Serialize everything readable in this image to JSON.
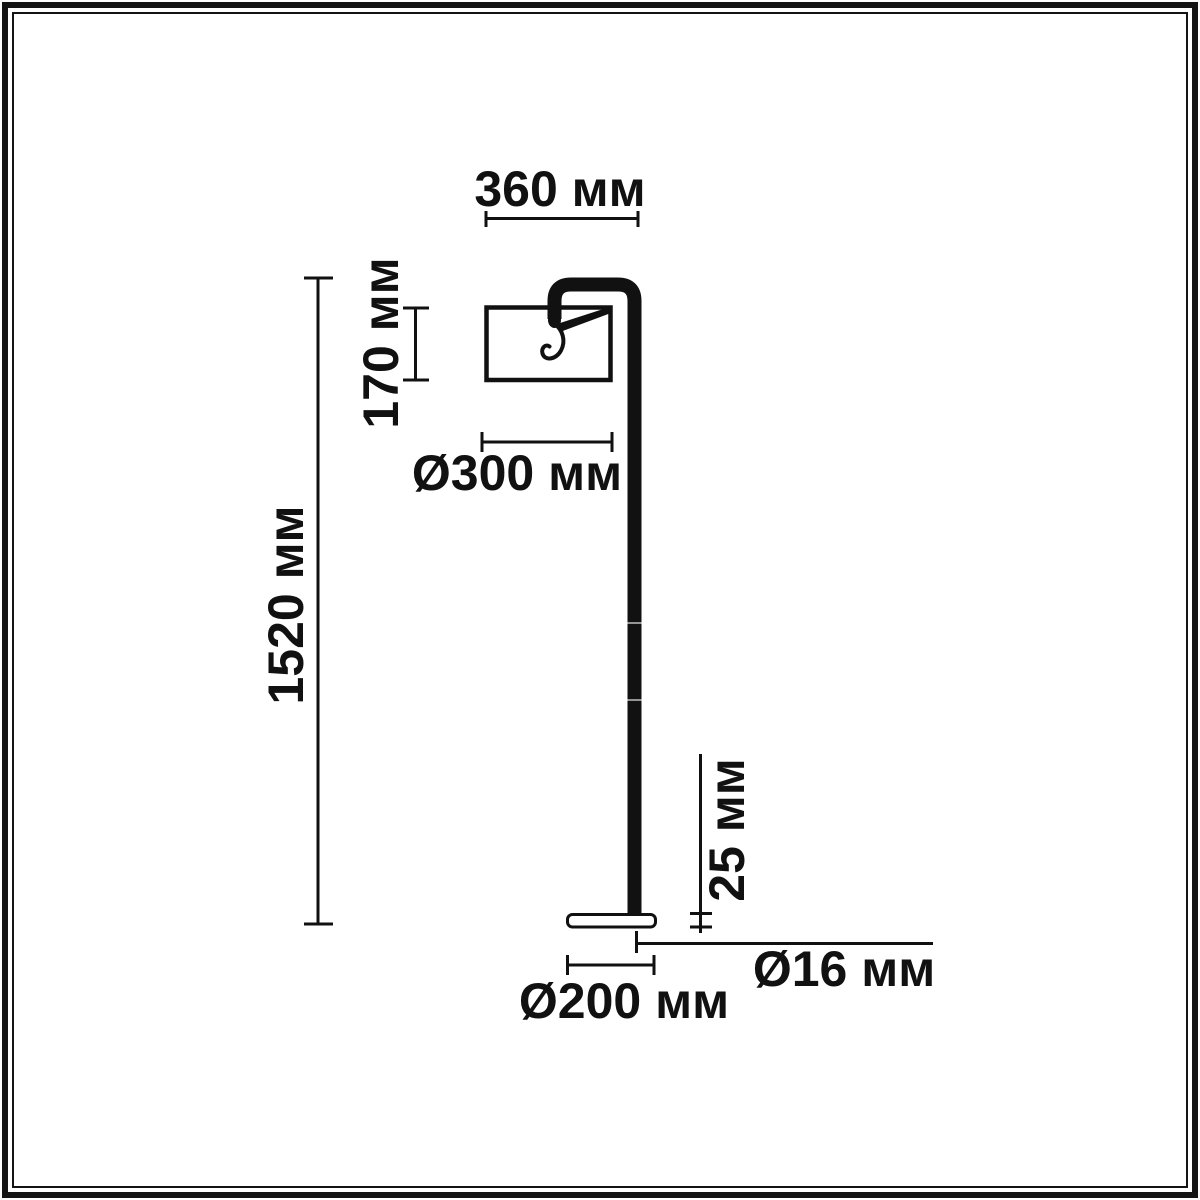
{
  "drawing": {
    "type": "dimensional-technical-drawing",
    "subject": "floor-lamp",
    "unit": "мм",
    "colors": {
      "ink": "#111111",
      "background": "#ffffff"
    },
    "labels": {
      "arm_reach": "360 мм",
      "shade_height": "170 мм",
      "shade_diameter": "Ø300 мм",
      "total_height": "1520 мм",
      "base_thickness": "25 мм",
      "pole_diameter": "Ø16 мм",
      "base_diameter": "Ø200 мм"
    }
  }
}
